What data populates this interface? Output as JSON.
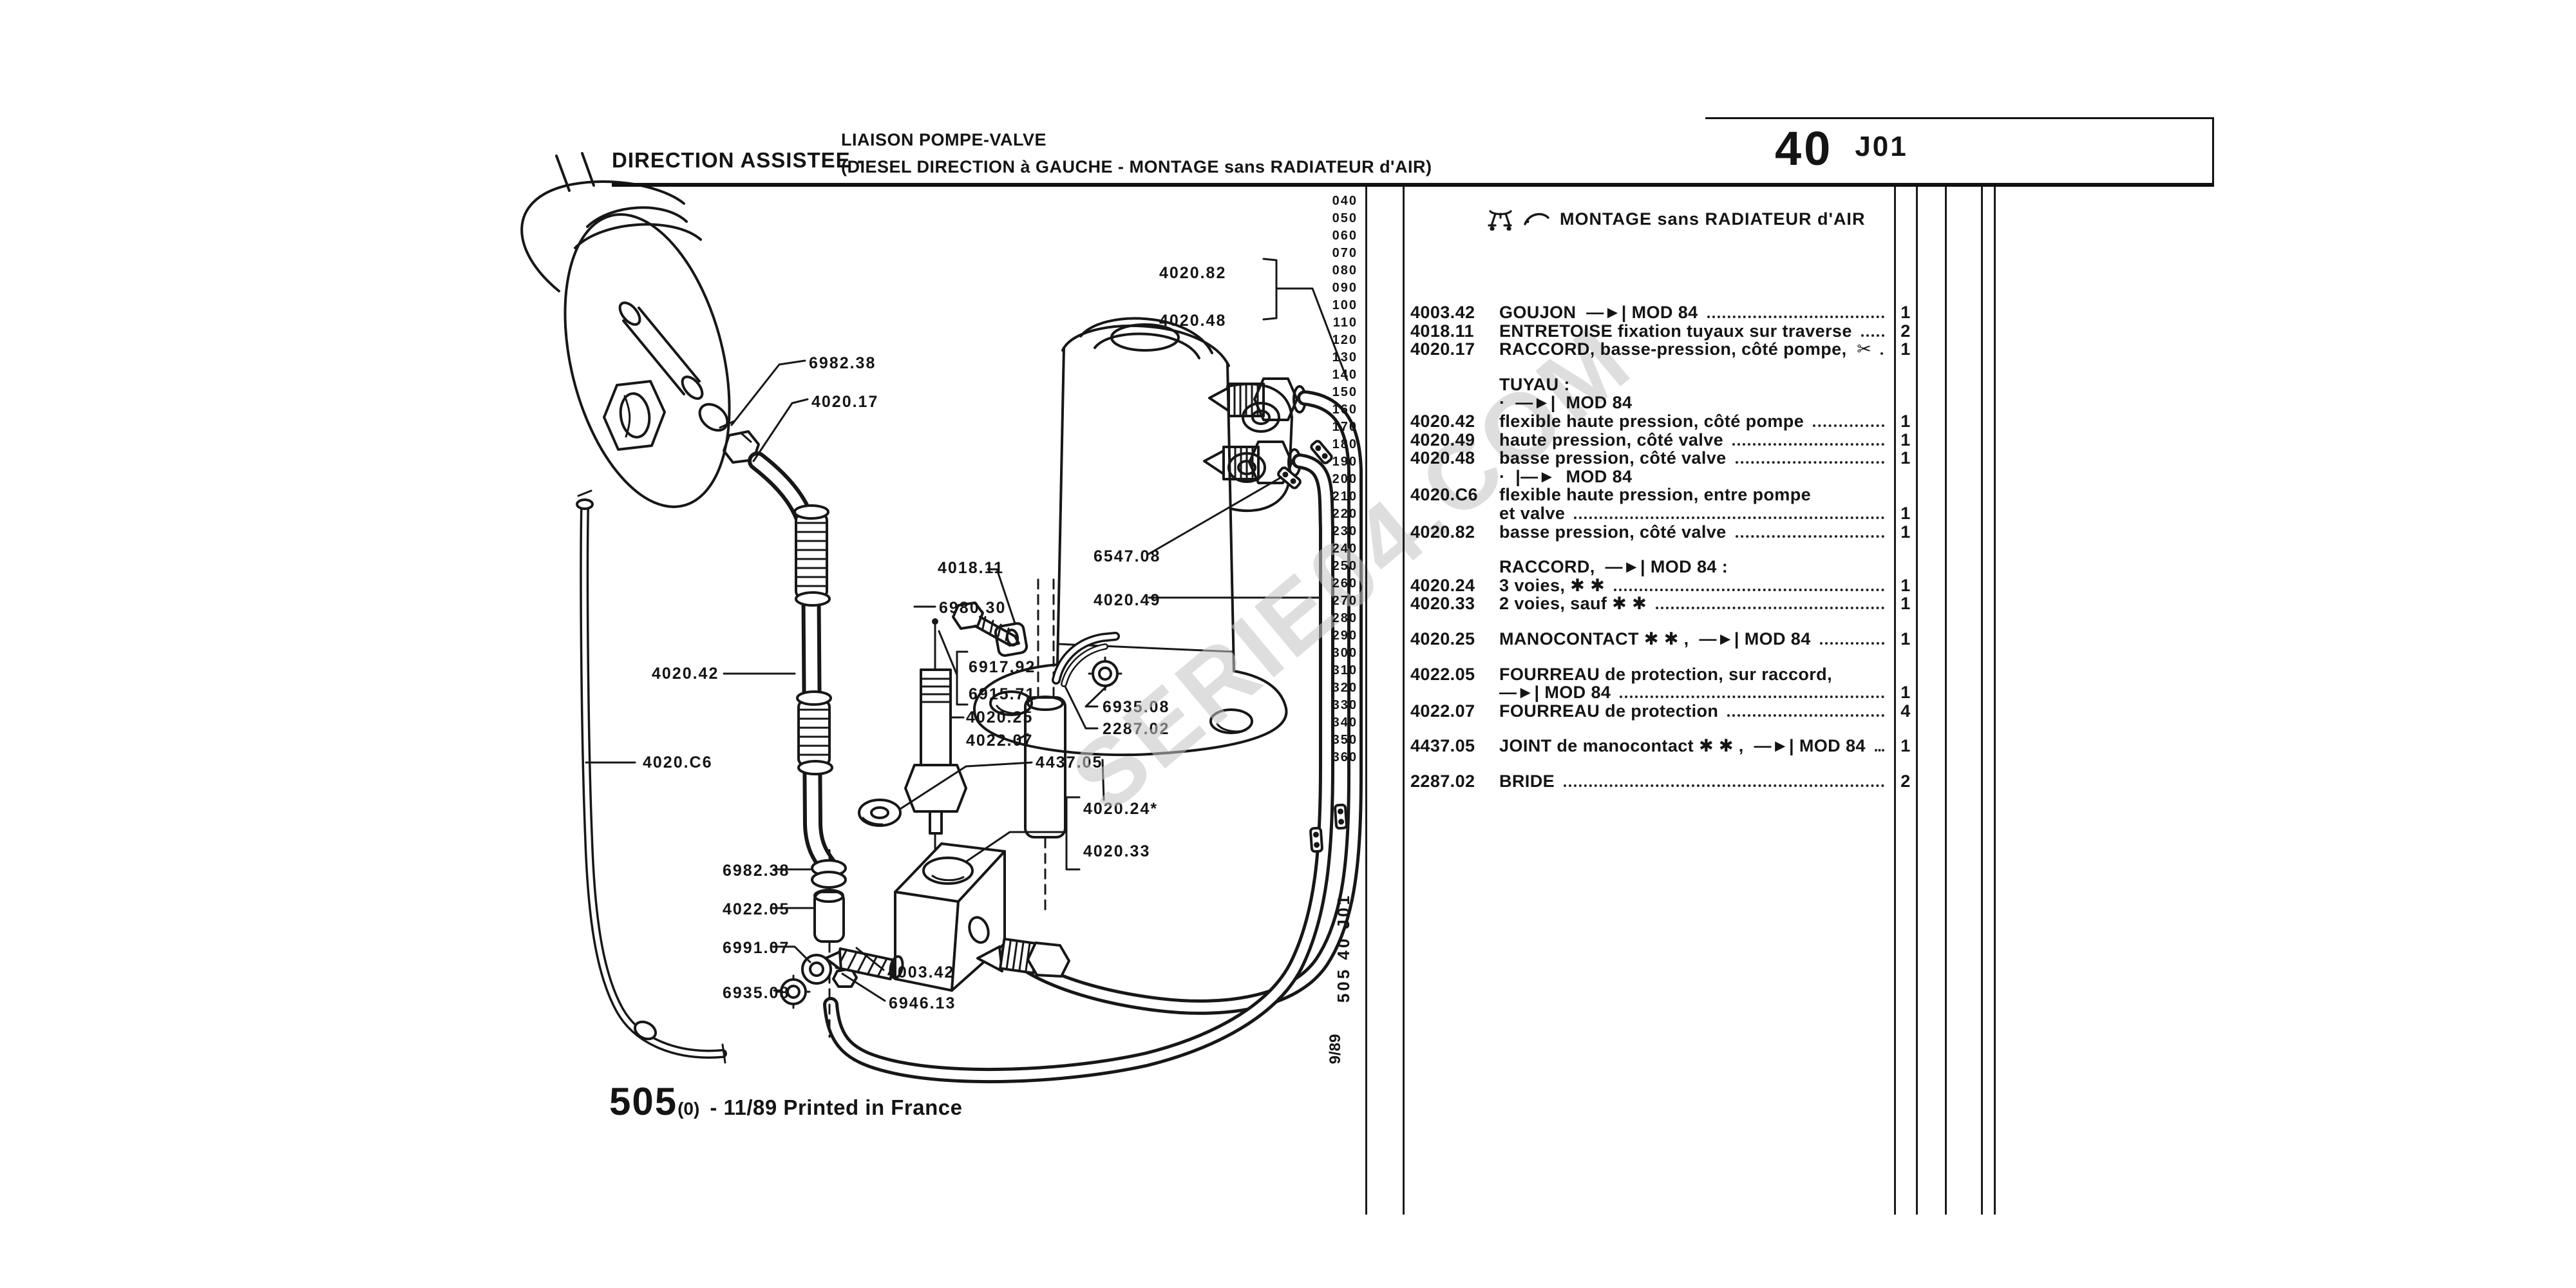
{
  "header": {
    "section": "DIRECTION ASSISTEE -",
    "subtitle_line1": "LIAISON POMPE-VALVE",
    "subtitle_line2": "(DIESEL DIRECTION à GAUCHE - MONTAGE sans RADIATEUR d'AIR)",
    "page_number": "40",
    "page_code": "J01"
  },
  "index_column": [
    "040",
    "050",
    "060",
    "070",
    "080",
    "090",
    "100",
    "110",
    "120",
    "130",
    "140",
    "150",
    "160",
    "170",
    "180",
    "190",
    "200",
    "210",
    "220",
    "230",
    "240",
    "250",
    "260",
    "270",
    "280",
    "290",
    "300",
    "310",
    "320",
    "330",
    "340",
    "350",
    "360"
  ],
  "parts_list": {
    "montage_note": "MONTAGE sans RADIATEUR d'AIR",
    "rows": [
      {
        "ref": "4003.42",
        "desc": "GOUJON  —►| MOD 84",
        "qty": "1",
        "cls": ""
      },
      {
        "ref": "4018.11",
        "desc": "ENTRETOISE fixation tuyaux sur traverse",
        "qty": "2",
        "cls": ""
      },
      {
        "ref": "4020.17",
        "desc": "RACCORD, basse-pression, côté pompe,  ✂",
        "qty": "1",
        "cls": ""
      },
      {
        "ref": "",
        "desc": "TUYAU :",
        "qty": "",
        "cls": "gap"
      },
      {
        "ref": "",
        "desc": "·  —►|  MOD 84",
        "qty": "",
        "cls": ""
      },
      {
        "ref": "4020.42",
        "desc": "flexible haute pression, côté pompe",
        "qty": "1",
        "cls": ""
      },
      {
        "ref": "4020.49",
        "desc": "haute pression, côté valve",
        "qty": "1",
        "cls": ""
      },
      {
        "ref": "4020.48",
        "desc": "basse pression, côté valve",
        "qty": "1",
        "cls": ""
      },
      {
        "ref": "",
        "desc": "·  |—►  MOD 84",
        "qty": "",
        "cls": ""
      },
      {
        "ref": "4020.C6",
        "desc": "flexible haute pression, entre pompe",
        "qty": "",
        "cls": ""
      },
      {
        "ref": "",
        "desc": "et valve",
        "qty": "1",
        "cls": ""
      },
      {
        "ref": "4020.82",
        "desc": "basse pression, côté valve",
        "qty": "1",
        "cls": ""
      },
      {
        "ref": "",
        "desc": "RACCORD,  —►| MOD 84 :",
        "qty": "",
        "cls": "gap"
      },
      {
        "ref": "4020.24",
        "desc": "3 voies, ✱ ✱",
        "qty": "1",
        "cls": ""
      },
      {
        "ref": "4020.33",
        "desc": "2 voies, sauf ✱ ✱",
        "qty": "1",
        "cls": ""
      },
      {
        "ref": "4020.25",
        "desc": "MANOCONTACT ✱ ✱ ,  —►| MOD 84",
        "qty": "1",
        "cls": "gap"
      },
      {
        "ref": "4022.05",
        "desc": "FOURREAU de protection, sur raccord,",
        "qty": "",
        "cls": "gap"
      },
      {
        "ref": "",
        "desc": "—►| MOD 84",
        "qty": "1",
        "cls": ""
      },
      {
        "ref": "4022.07",
        "desc": "FOURREAU de protection",
        "qty": "4",
        "cls": ""
      },
      {
        "ref": "4437.05",
        "desc": "JOINT de manocontact ✱ ✱ ,  —►| MOD 84",
        "qty": "1",
        "cls": "gap"
      },
      {
        "ref": "2287.02",
        "desc": "BRIDE",
        "qty": "2",
        "cls": "gap"
      }
    ]
  },
  "diagram": {
    "labels": {
      "clamp_top": "6982.38",
      "raccord_pump": "4020.17",
      "hose_bp_valve_82": "4020.82",
      "hose_bp_valve_48": "4020.48",
      "entretoise": "4018.11",
      "screw_6980": "6980.30",
      "clip_6547": "6547.08",
      "hose_hp_valve": "4020.49",
      "screw_6917": "6917.92",
      "screw_6915": "6915.71",
      "manocontact": "4020.25",
      "fourreau_07": "4022.07",
      "nut_mid": "6935.08",
      "bride": "2287.02",
      "joint": "4437.05",
      "hose_hp_pump": "4020.42",
      "hose_c6": "4020.C6",
      "raccord_3v": "4020.24*",
      "raccord_2v": "4020.33",
      "clamp_bottom": "6982.38",
      "fourreau_05": "4022.05",
      "banjo": "6991.07",
      "goujon": "4003.42",
      "nut_bottom": "6935.08",
      "screw_6946": "6946.13"
    },
    "watermark": "SERIE04.COM"
  },
  "footer": {
    "doc_number": "505",
    "doc_suffix": "(0)",
    "print_info": "- 11/89 Printed in France",
    "side_code": "505 40 J01",
    "side_date": "9/89"
  }
}
